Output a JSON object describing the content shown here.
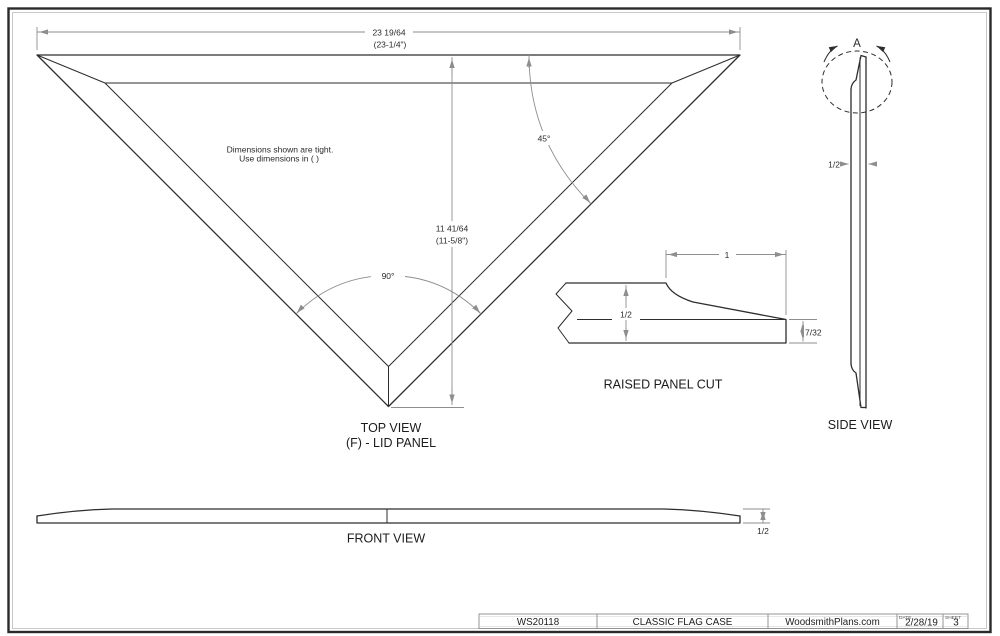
{
  "sheet": {
    "note": {
      "line1": "Dimensions shown are tight.",
      "line2": "Use dimensions in ( )"
    },
    "top_view": {
      "width_dim": "23 19/64",
      "width_dim_paren": "(23-1/4\")",
      "height_dim": "11 41/64",
      "height_dim_paren": "(11-5/8\")",
      "angle_top_right": "45°",
      "angle_bottom": "90°",
      "label_line1": "TOP VIEW",
      "label_line2": "(F) - LID PANEL"
    },
    "raised_panel_cut": {
      "label": "RAISED PANEL CUT",
      "bevel_width_dim": "1",
      "thickness_dim": "1/2",
      "edge_dim": "7/32"
    },
    "side_view": {
      "label": "SIDE VIEW",
      "detail_marker": "A",
      "thickness_dim": "1/2"
    },
    "front_view": {
      "label": "FRONT VIEW",
      "thickness_dim": "1/2"
    },
    "title_block": {
      "item_number": "WS20118",
      "title": "CLASSIC FLAG CASE",
      "source": "WoodsmithPlans.com",
      "date_label": "DATE",
      "date_value": "2/28/19",
      "sheet_label": "SHEET",
      "sheet_value": "3"
    },
    "colors": {
      "ink": "#2d2d2d",
      "dim_line": "#8e8e8e",
      "border": "#2a2a2a"
    }
  }
}
